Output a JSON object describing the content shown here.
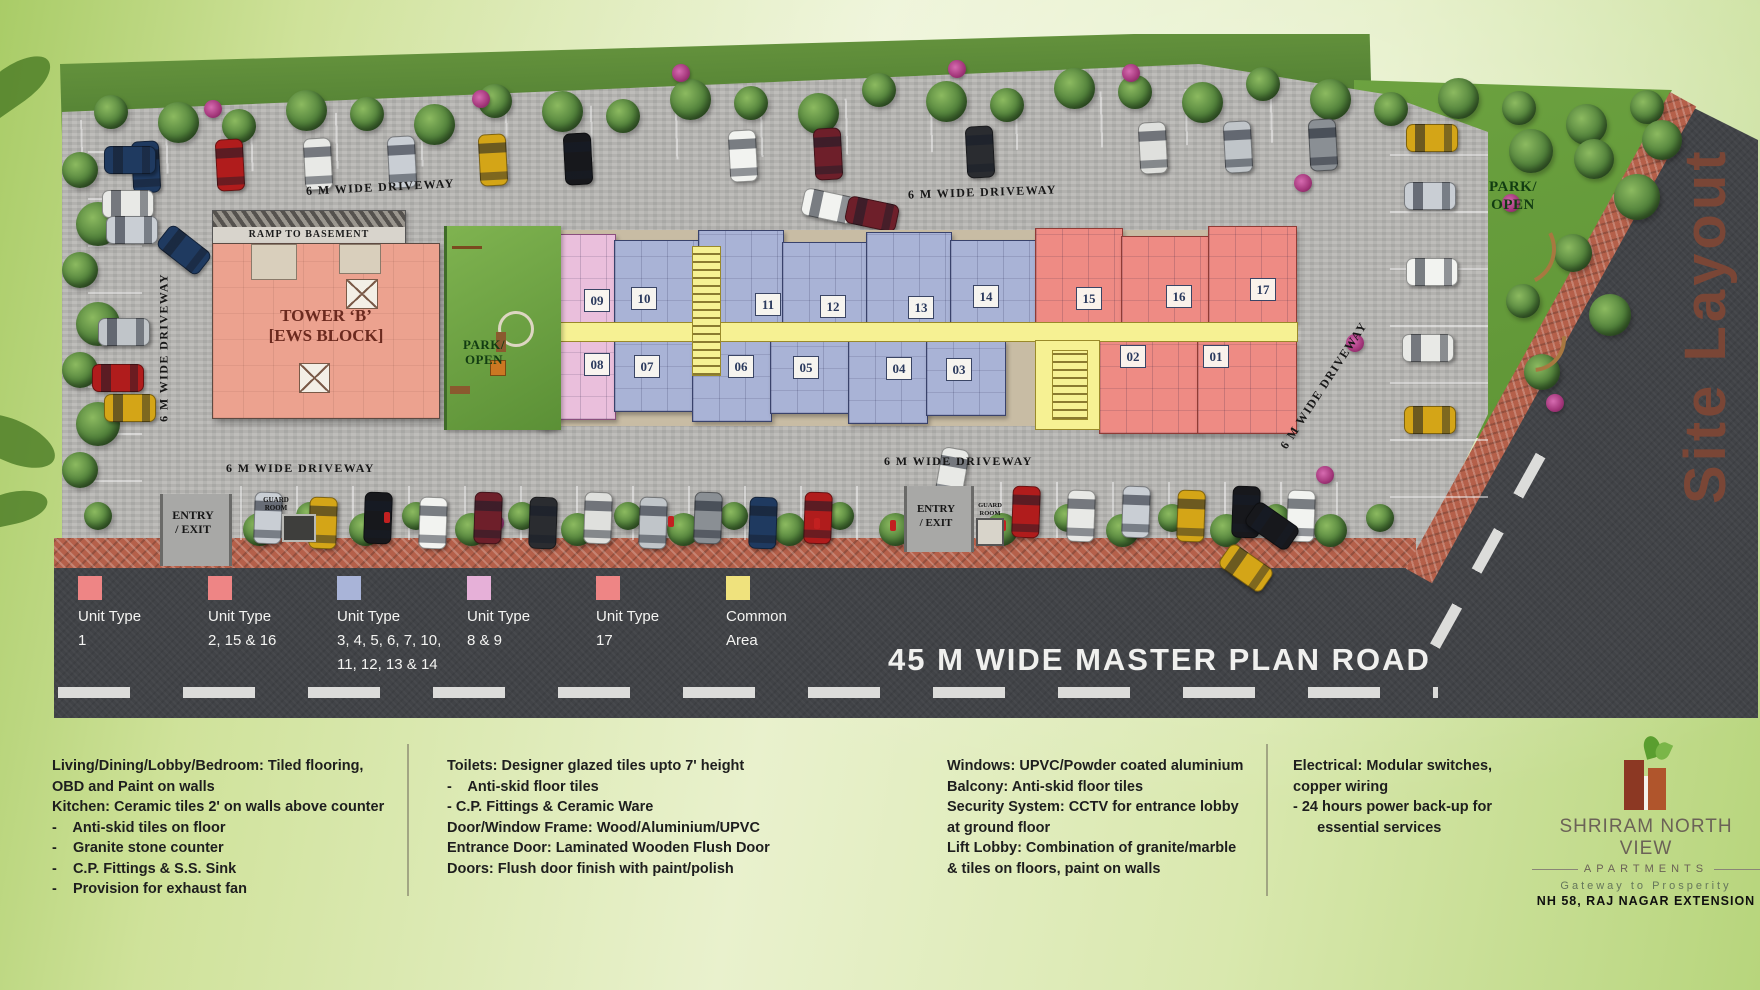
{
  "title": "Site Layout",
  "plan": {
    "driveway_label": "6 M WIDE DRIVEWAY",
    "ramp_label": "RAMP TO BASEMENT",
    "tower_line1": "TOWER ‘B’",
    "tower_line2": "[EWS BLOCK]",
    "park_line1": "PARK/",
    "park_line2": "OPEN",
    "entry_line1": "ENTRY",
    "entry_line2": "/ EXIT",
    "guard_line1": "GUARD",
    "guard_line2": "ROOM",
    "units_top": [
      "09",
      "10",
      "11",
      "12",
      "13",
      "14",
      "15",
      "16",
      "17"
    ],
    "units_bottom": [
      "08",
      "07",
      "06",
      "05",
      "04",
      "03",
      "02",
      "01"
    ]
  },
  "legend": {
    "items": [
      {
        "label": "Unit Type",
        "value": "1",
        "color": "#ee8585"
      },
      {
        "label": "Unit Type",
        "value": "2, 15 & 16",
        "color": "#ee8585"
      },
      {
        "label": "Unit Type",
        "value": "3, 4, 5, 6, 7, 10,\n11, 12, 13 & 14",
        "color": "#a9b4d8"
      },
      {
        "label": "Unit Type",
        "value": "8 & 9",
        "color": "#e6b0d8"
      },
      {
        "label": "Unit Type",
        "value": "17",
        "color": "#ee8585"
      },
      {
        "label": "Common\nArea",
        "value": "",
        "color": "#efe27d"
      }
    ]
  },
  "road_label": "45 M WIDE MASTER PLAN ROAD",
  "specs": {
    "columns": [
      {
        "lines": [
          "Living/Dining/Lobby/Bedroom: Tiled flooring,",
          "OBD and Paint on walls",
          "Kitchen: Ceramic tiles 2' on walls above counter",
          "-    Anti-skid tiles on floor",
          "-    Granite stone counter",
          "-    C.P. Fittings & S.S. Sink",
          "-    Provision for exhaust fan"
        ]
      },
      {
        "lines": [
          "Toilets: Designer glazed tiles upto 7' height",
          "-    Anti-skid floor tiles",
          "- C.P. Fittings & Ceramic Ware",
          "Door/Window Frame: Wood/Aluminium/UPVC",
          "Entrance Door: Laminated Wooden Flush Door",
          "Doors: Flush door finish with paint/polish"
        ]
      },
      {
        "lines": [
          "Windows: UPVC/Powder coated aluminium",
          "Balcony: Anti-skid floor tiles",
          "Security System: CCTV for entrance lobby",
          "at ground floor",
          "Lift Lobby: Combination of granite/marble",
          "& tiles on floors, paint on walls"
        ]
      },
      {
        "lines": [
          "Electrical: Modular switches,",
          "copper wiring",
          "- 24 hours power back-up for",
          "      essential services"
        ]
      }
    ]
  },
  "brand": {
    "name": "SHRIRAM NORTH VIEW",
    "category": "APARTMENTS",
    "tagline": "Gateway to Prosperity",
    "location": "NH 58, RAJ NAGAR EXTENSION"
  }
}
